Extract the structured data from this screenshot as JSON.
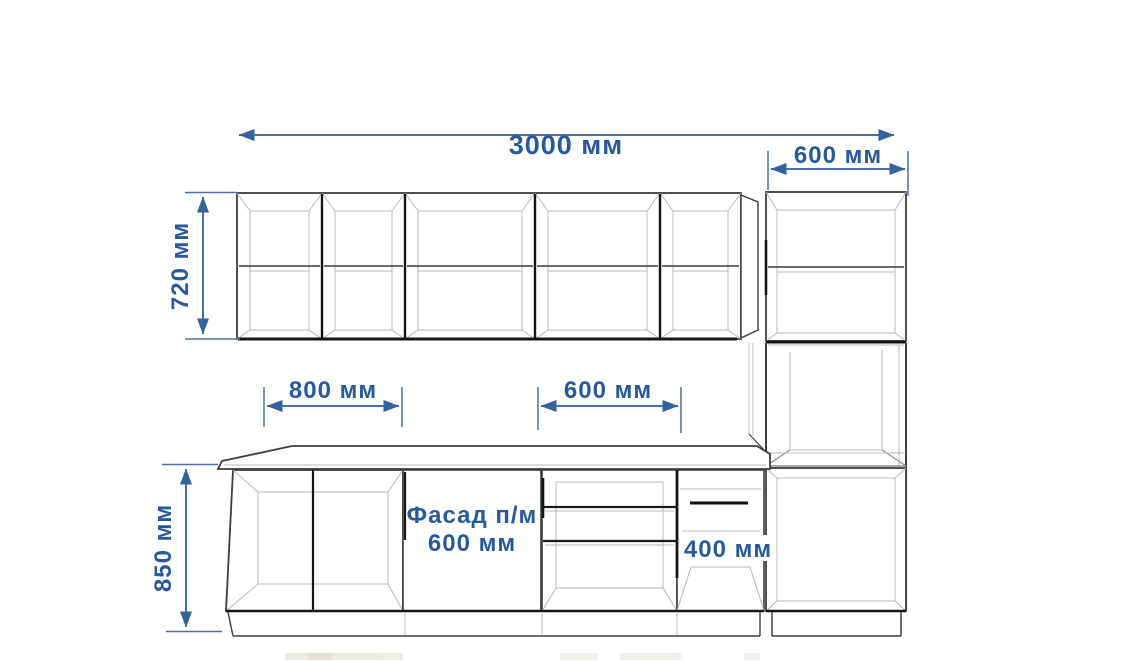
{
  "diagram": {
    "dimension_labels": {
      "total_width": "3000 мм",
      "tall_cabinet_width": "600 мм",
      "wall_cabinets_height": "720 мм",
      "base_cabinet_left_width": "800 мм",
      "base_cabinet_mid_width": "600 мм",
      "base_cabinets_height": "850 мм",
      "narrow_base_cabinet_width": "400 мм",
      "facade_note_line1": "Фасад п/м",
      "facade_note_line2": "600 мм"
    },
    "colors": {
      "dimension_text": "#29599c",
      "dimension_line": "#4c6fa4",
      "arrowhead": "#35619e",
      "cabinet_outline": "#3d3d3d",
      "cabinet_inner_line": "#b8b8b8",
      "background": "#ffffff"
    }
  }
}
